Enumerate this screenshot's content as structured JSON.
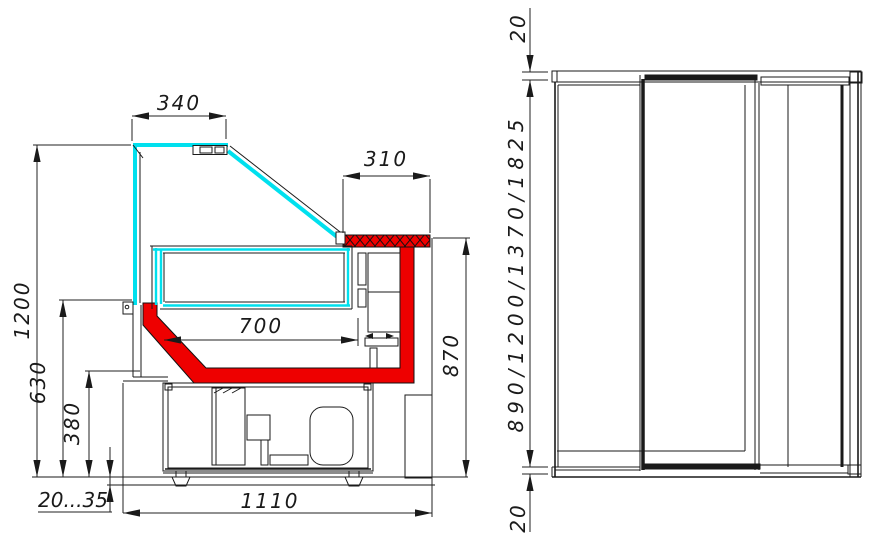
{
  "drawing": {
    "section_view": {
      "dims": {
        "canopy_depth": "340",
        "shelf_depth": "310",
        "well_width": "700",
        "glass_height": "1200",
        "front_panel_height": "630",
        "base_height": "380",
        "leg_adjustment": "20...35",
        "overall_depth": "1110",
        "worktop_height": "870"
      }
    },
    "side_view": {
      "dims": {
        "top_gap": "20",
        "height_options": "890/1200/1370/1825",
        "bottom_gap": "20"
      }
    },
    "colors": {
      "glass": "#00E0EE",
      "highlight": "#EE0000",
      "line": "#1A1A1A"
    }
  }
}
